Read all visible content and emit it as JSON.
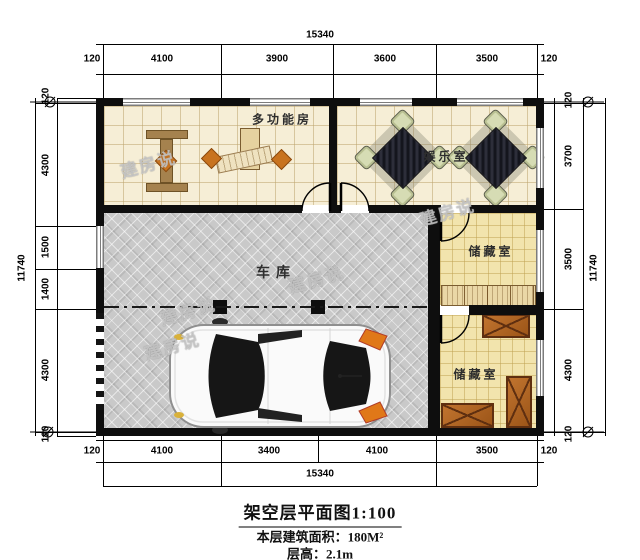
{
  "plan": {
    "rooms": {
      "multi_function": "多功能房",
      "entertainment": "娱乐室",
      "garage": "车库",
      "storage_upper": "储藏室",
      "storage_lower": "储藏室"
    },
    "watermark": "建房说"
  },
  "dimensions": {
    "top": {
      "overall": "15340",
      "segments": [
        "120",
        "4100",
        "3900",
        "3600",
        "3500",
        "120"
      ]
    },
    "bottom": {
      "overall": "15340",
      "segments": [
        "120",
        "4100",
        "3400",
        "4100",
        "3500",
        "120"
      ]
    },
    "left": {
      "overall": "11740",
      "segments": [
        "120",
        "4300",
        "1500",
        "1400",
        "4300",
        "120"
      ]
    },
    "right": {
      "overall": "11740",
      "segments": [
        "120",
        "3700",
        "3500",
        "4300",
        "120"
      ]
    }
  },
  "title_block": {
    "title": "架空层平面图1:100",
    "floor_area": "本层建筑面积：180M²",
    "floor_height": "层高：2.1m"
  },
  "colors": {
    "wall": "#0e0e0e",
    "tile_cream": "#f6eed6",
    "tile_yellow": "#f2e4ad",
    "garage_floor": "#c9c9c9",
    "crate_brown": "#9c5518",
    "table_dark": "#14151d",
    "chair_green": "#d6dcb4",
    "accent_orange": "#c8731f"
  }
}
